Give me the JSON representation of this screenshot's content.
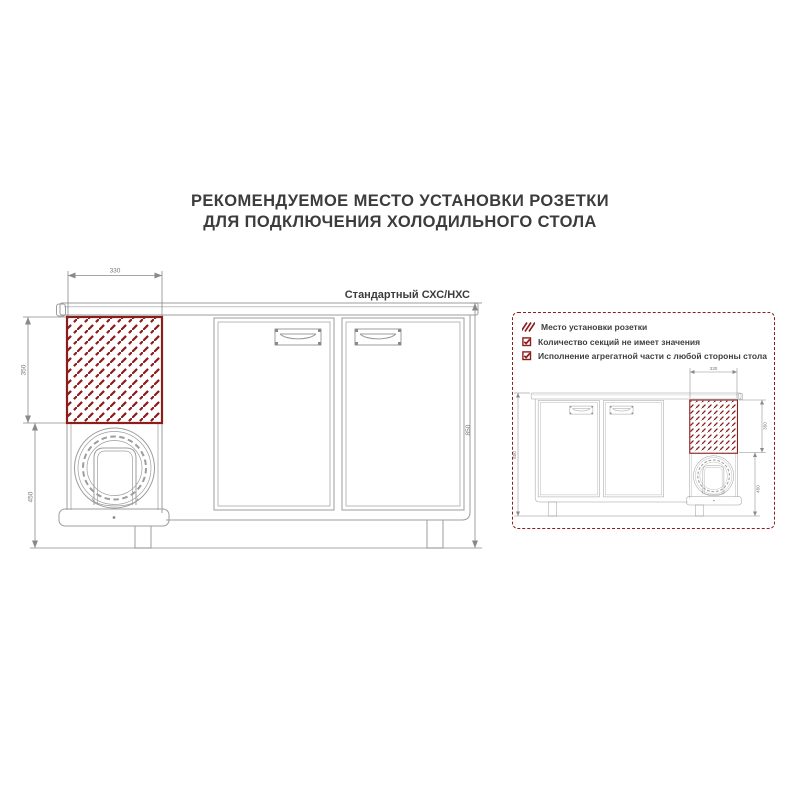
{
  "title": {
    "line1": "РЕКОМЕНДУЕМОЕ МЕСТО УСТАНОВКИ РОЗЕТКИ",
    "line2": "ДЛЯ ПОДКЛЮЧЕНИЯ ХОЛОДИЛЬНОГО СТОЛА"
  },
  "main_drawing": {
    "label": "Стандартный СХС/НХС",
    "dims": {
      "socket_width": "330",
      "socket_height": "350",
      "compressor_height": "450",
      "table_height": "850"
    }
  },
  "info_panel": {
    "legend": [
      {
        "icon": "hatch-swatch",
        "text": "Место установки розетки"
      },
      {
        "icon": "checkbox",
        "text": "Количество секций не имеет значения"
      },
      {
        "icon": "checkbox",
        "text": "Исполнение агрегатной части с любой стороны стола"
      }
    ],
    "dims": {
      "socket_width": "330",
      "socket_height": "350",
      "compressor_height": "450",
      "table_height": "850"
    }
  },
  "colors": {
    "accent_red": "#8b1d1d",
    "line_gray": "#9d9d9d",
    "dim_gray": "#8a8a8a",
    "text_dark": "#3c3c3c"
  }
}
